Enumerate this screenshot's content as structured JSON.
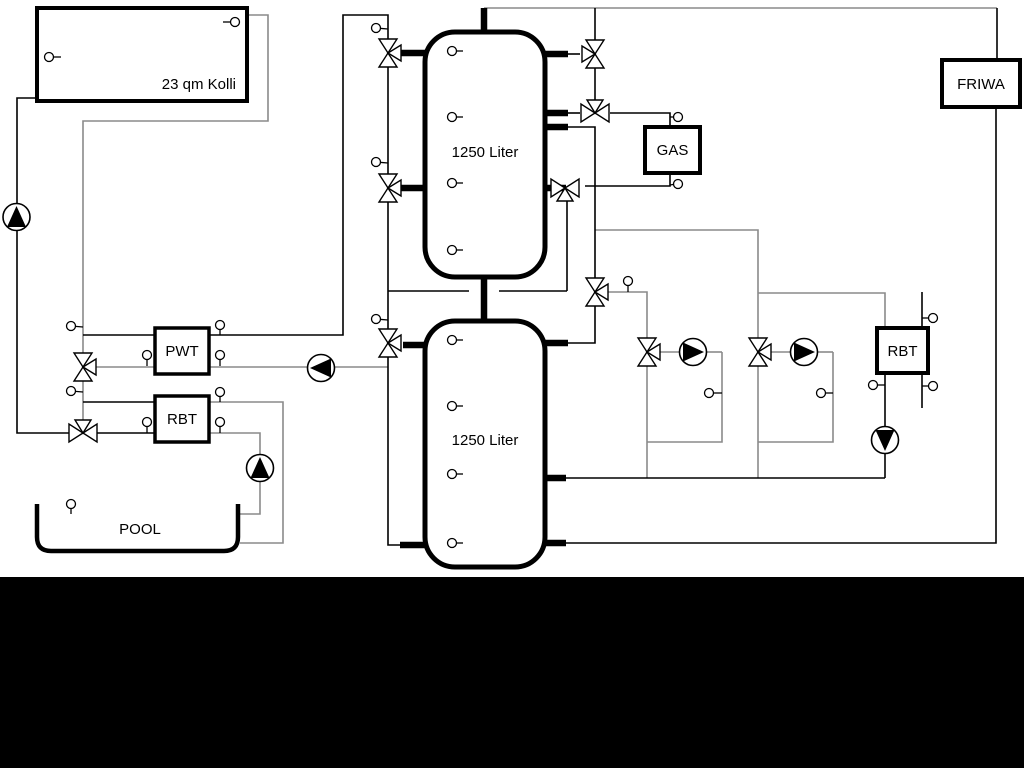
{
  "diagram": {
    "labels": {
      "collector": "23 qm Kolli",
      "tank_top": "1250 Liter",
      "tank_bottom": "1250 Liter",
      "pwt": "PWT",
      "rbt_left": "RBT",
      "rbt_right": "RBT",
      "gas": "GAS",
      "friwa": "FRIWA",
      "pool": "POOL"
    },
    "colors": {
      "background": "#ffffff",
      "bottom_band": "#000000",
      "pipe_gray": "#8a8a8a",
      "pipe_black": "#000000",
      "component_outline": "#000000",
      "component_fill": "#ffffff"
    }
  }
}
